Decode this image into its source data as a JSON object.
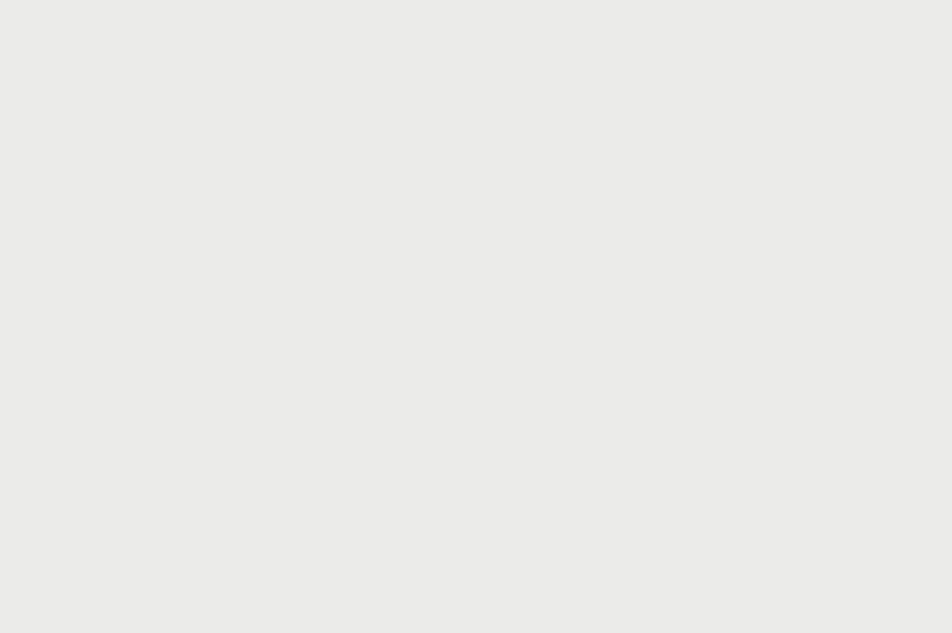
{
  "colors": {
    "sign_blue": "#1e3c8c",
    "sign_red": "#d5232c",
    "road_white": "#ffffff",
    "land": "#ebebe9",
    "pale_land": "#f1f1e8",
    "park_green": "#dce6cb",
    "building": "#d9d8d6",
    "building_dark": "#cdcdcb",
    "street_label": "#4a4a4a",
    "transit_blue": "#4a77b4",
    "area_label": "#8995a6",
    "parking_blue": "#8da4c0",
    "route_dash_blue": "#8a9fd8",
    "dotted_red": "#d09a9a"
  },
  "map": {
    "street_labels": [
      {
        "t": "Pesti utca",
        "x": 453,
        "y": 42,
        "r": 87,
        "s": 11
      },
      {
        "t": "Segner tér",
        "x": 472,
        "y": 150,
        "r": 78,
        "s": 11
      },
      {
        "t": "Segner tér",
        "x": 522,
        "y": 258,
        "r": 32,
        "s": 11
      },
      {
        "t": "Vendég utca",
        "x": 598,
        "y": 252,
        "r": -22,
        "s": 11
      },
      {
        "t": "Jókai utca",
        "x": 612,
        "y": 29,
        "r": -29,
        "s": 11
      },
      {
        "t": "Zsák utca",
        "x": 806,
        "y": 56,
        "r": -20,
        "s": 11
      },
      {
        "t": "Csokonai utca",
        "x": 818,
        "y": 84,
        "r": -19,
        "s": 11
      },
      {
        "t": "Zúgó u",
        "x": 941,
        "y": 87,
        "r": 72,
        "s": 10
      },
      {
        "t": "a utca",
        "x": 877,
        "y": 16,
        "r": 55,
        "s": 10
      },
      {
        "t": "Hatvan utca",
        "x": 702,
        "y": 266,
        "r": -13,
        "s": 11
      },
      {
        "t": "Hatvan utca",
        "x": 858,
        "y": 233,
        "r": -10,
        "s": 11
      },
      {
        "t": "Hatva",
        "x": 838,
        "y": 281,
        "r": 78,
        "s": 10
      },
      {
        "t": "Kishegyesi út",
        "x": 117,
        "y": 321,
        "r": -8,
        "s": 11
      },
      {
        "t": "Kishegyesi út",
        "x": 223,
        "y": 290,
        "r": -9,
        "s": 11
      },
      {
        "t": "Kishegyesi út",
        "x": 352,
        "y": 262,
        "r": -11,
        "s": 11
      },
      {
        "t": "Nyugati utca",
        "x": 731,
        "y": 449,
        "r": 60,
        "s": 11
      },
      {
        "t": "Nyugati utca",
        "x": 822,
        "y": 541,
        "r": 60,
        "s": 11
      },
      {
        "t": "Szepességi utca",
        "x": 929,
        "y": 524,
        "r": 55,
        "s": 11
      },
      {
        "t": "Ba",
        "x": 947,
        "y": 389,
        "r": 55,
        "s": 10
      },
      {
        "t": "Kürtős utca",
        "x": 529,
        "y": 417,
        "r": 80,
        "s": 11
      },
      {
        "t": "Kürtős utca",
        "x": 577,
        "y": 587,
        "r": 75,
        "s": 11
      },
      {
        "t": "István út",
        "x": 247,
        "y": 332,
        "r": 80,
        "s": 11
      },
      {
        "t": "István út",
        "x": 127,
        "y": 546,
        "r": 72,
        "s": 11
      },
      {
        "t": "István út",
        "x": 193,
        "y": 528,
        "r": 72,
        "s": 11
      },
      {
        "t": "Sesztina utca",
        "x": 350,
        "y": 357,
        "r": -16,
        "s": 11
      },
      {
        "t": "Vasáros utca",
        "x": 426,
        "y": 528,
        "r": 83,
        "s": 11
      },
      {
        "t": "Erőss Lajos utca",
        "x": 398,
        "y": 602,
        "r": 13,
        "s": 11
      }
    ],
    "area_labels": [
      {
        "t": "Segner",
        "x": 567,
        "y": 309
      },
      {
        "t": "tér",
        "x": 569,
        "y": 320
      }
    ],
    "transit_labels": [
      {
        "t": "Segner",
        "x": 703,
        "y": 389
      },
      {
        "t": "tér",
        "x": 705,
        "y": 400
      },
      {
        "t": "Erőss Lajos",
        "x": 187,
        "y": 579
      },
      {
        "t": "utca",
        "x": 187,
        "y": 591
      },
      {
        "t": "na",
        "x": 237,
        "y": 373
      }
    ],
    "house_numbers": [
      {
        "t": "13",
        "x": 633,
        "y": 50
      },
      {
        "t": "49",
        "x": 665,
        "y": 5
      },
      {
        "t": "6",
        "x": 536,
        "y": 148
      }
    ],
    "parking_labels": [
      {
        "t": "P",
        "x": 345,
        "y": 193,
        "s": 15
      },
      {
        "t": "P",
        "x": 263,
        "y": 373,
        "s": 10
      }
    ],
    "icons": {
      "bus_stops": [
        [
          182,
          288
        ],
        [
          566,
          296
        ],
        [
          583,
          347
        ],
        [
          647,
          457
        ],
        [
          762,
          241
        ],
        [
          767,
          258
        ],
        [
          903,
          626
        ],
        [
          225,
          356
        ],
        [
          582,
          391
        ]
      ],
      "traffic_lights": [
        [
          257,
          287
        ],
        [
          469,
          186
        ],
        [
          603,
          301
        ],
        [
          633,
          294
        ],
        [
          647,
          322
        ],
        [
          754,
          452
        ]
      ],
      "fuel": [
        [
          686,
          438
        ]
      ],
      "charging": [
        [
          668,
          415
        ]
      ],
      "mast": [
        [
          443,
          180
        ]
      ],
      "park_feature": [
        [
          44,
          506
        ]
      ]
    }
  },
  "signs": [
    {
      "id": "sign-pesti-south",
      "cx": 378,
      "cy": 82,
      "w": 142,
      "h": 108,
      "rot": -8,
      "orient": "v",
      "sw": 10,
      "lanes": [
        {
          "glyph": "down-left"
        },
        {
          "glyph": "down",
          "crossed": true
        },
        {
          "glyph": "down",
          "crossed": true
        }
      ]
    },
    {
      "id": "sign-kishegyesi-east",
      "cx": 180,
      "cy": 243,
      "w": 168,
      "h": 98,
      "rot": -8,
      "orient": "v",
      "sw": 10,
      "lanes": [
        {
          "glyph": "down-left"
        },
        {
          "glyph": "down"
        },
        {
          "glyph": "down-right-slight",
          "crossed": true
        },
        {
          "glyph": "down-right-diag",
          "crossed": true
        }
      ]
    },
    {
      "id": "sign-kishegyesi-west",
      "cx": 134,
      "cy": 390,
      "w": 102,
      "h": 118,
      "rot": -12,
      "orient": "h",
      "sw": 9,
      "lanes": [
        {
          "glyph": "right-up"
        },
        {
          "glyph": "right",
          "crossed": true
        },
        {
          "glyph": "right-low",
          "branch": "branch-up-right-c",
          "branch_crossed": true
        }
      ]
    },
    {
      "id": "sign-sesztina",
      "cx": 419,
      "cy": 312,
      "w": 100,
      "h": 118,
      "rot": -15,
      "orient": "h",
      "sw": 9,
      "lanes": [
        {
          "glyph": "right-diag1",
          "crossed": true
        },
        {
          "glyph": "right-diag2",
          "crossed": true
        },
        {
          "glyph": "right-diag3",
          "crossed": true
        }
      ]
    },
    {
      "id": "sign-istvan",
      "cx": 287,
      "cy": 531,
      "w": 128,
      "h": 96,
      "rot": 0,
      "orient": "v",
      "sw": 10,
      "lanes": [
        {
          "glyph": "up-left"
        },
        {
          "glyph": "up",
          "branch": "branch-up-right-e",
          "branch_crossed": true
        },
        {
          "glyph": "up-right-diag",
          "crossed": true
        }
      ]
    },
    {
      "id": "sign-kurtos",
      "cx": 600,
      "cy": 437,
      "w": 88,
      "h": 96,
      "rot": 40,
      "orient": "v",
      "sw": 9,
      "lanes": [
        {
          "glyph": "up-left",
          "crossed": true
        },
        {
          "glyph": "up",
          "crossed": true
        }
      ]
    },
    {
      "id": "sign-vendeg",
      "cx": 687,
      "cy": 172,
      "w": 102,
      "h": 106,
      "rot": -23,
      "orient": "h",
      "sw": 9,
      "lanes": [
        {
          "glyph": "left-up",
          "crossed": true
        },
        {
          "glyph": "left-mid",
          "crossed": true
        },
        {
          "glyph": "left",
          "crossed": true
        }
      ]
    },
    {
      "id": "sign-hatvan",
      "cx": 808,
      "cy": 365,
      "w": 136,
      "h": 102,
      "rot": -40,
      "orient": "v",
      "sw": 10,
      "lanes": [
        {
          "glyph": "turn-left-up",
          "crossed": true
        },
        {
          "glyph": "up",
          "crossed": true
        },
        {
          "glyph": "up",
          "crossed": true
        },
        {
          "glyph": "up-bend-right"
        }
      ]
    }
  ],
  "no_entry_markers": [
    {
      "x": 427,
      "y": 151,
      "r": 27,
      "rot": 8
    },
    {
      "x": 619,
      "y": 203,
      "r": 27,
      "rot": -65
    },
    {
      "x": 490,
      "y": 287,
      "r": 26,
      "rot": -73
    },
    {
      "x": 213,
      "y": 383,
      "r": 26,
      "rot": -68
    },
    {
      "x": 649,
      "y": 379,
      "r": 26,
      "rot": 36
    },
    {
      "x": 740,
      "y": 310,
      "r": 27,
      "rot": -20
    }
  ],
  "connectors": [
    {
      "x1": 288,
      "y1": 481,
      "x2": 253,
      "y2": 306
    },
    {
      "x1": 611,
      "y1": 393,
      "x2": 627,
      "y2": 333
    },
    {
      "x1": 666,
      "y1": 242,
      "x2": 630,
      "y2": 288
    }
  ]
}
